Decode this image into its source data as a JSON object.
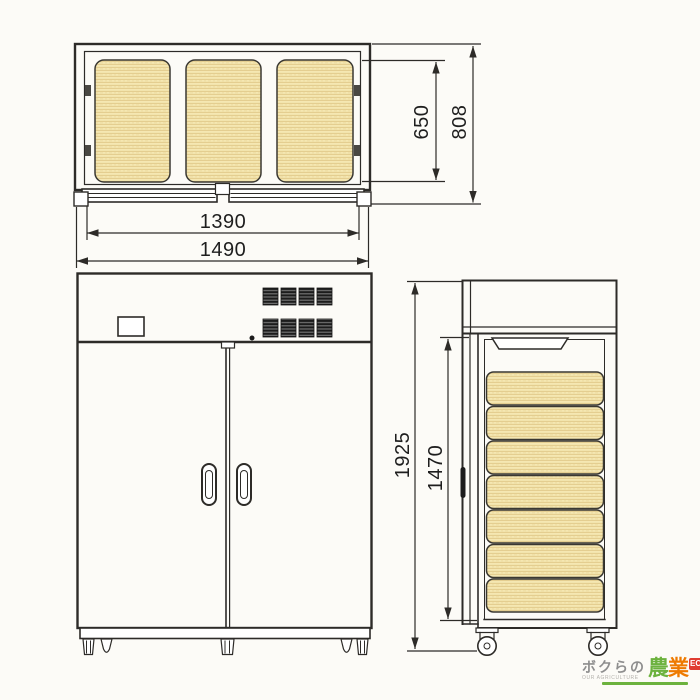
{
  "plan_view": {
    "dims": {
      "inner_width": "1390",
      "overall_width": "1490",
      "inner_depth": "650",
      "overall_depth": "808"
    },
    "sack_count": 3
  },
  "front_view": {
    "vent_count": 8,
    "door_count": 2,
    "handle_count": 2,
    "feet_count": 5
  },
  "side_view": {
    "dims": {
      "overall_height": "1925",
      "interior_height": "1470"
    },
    "sack_count": 7,
    "caster_count": 2
  },
  "logo": {
    "text_ja": "ボクらの",
    "text_en": "OUR AGRICULTURE",
    "mark_char_1": "農",
    "mark_char_2": "業",
    "badge": "EC"
  },
  "colors": {
    "line": "#2d2b28",
    "paper": "#fcfbf7",
    "sack_fill": "#f5e7b2",
    "sack_stripe": "#e2cb8c",
    "logo_green": "#6cb23e",
    "logo_orange": "#ee7a00",
    "logo_red": "#e03c31",
    "logo_gray": "#8e8e8e"
  }
}
